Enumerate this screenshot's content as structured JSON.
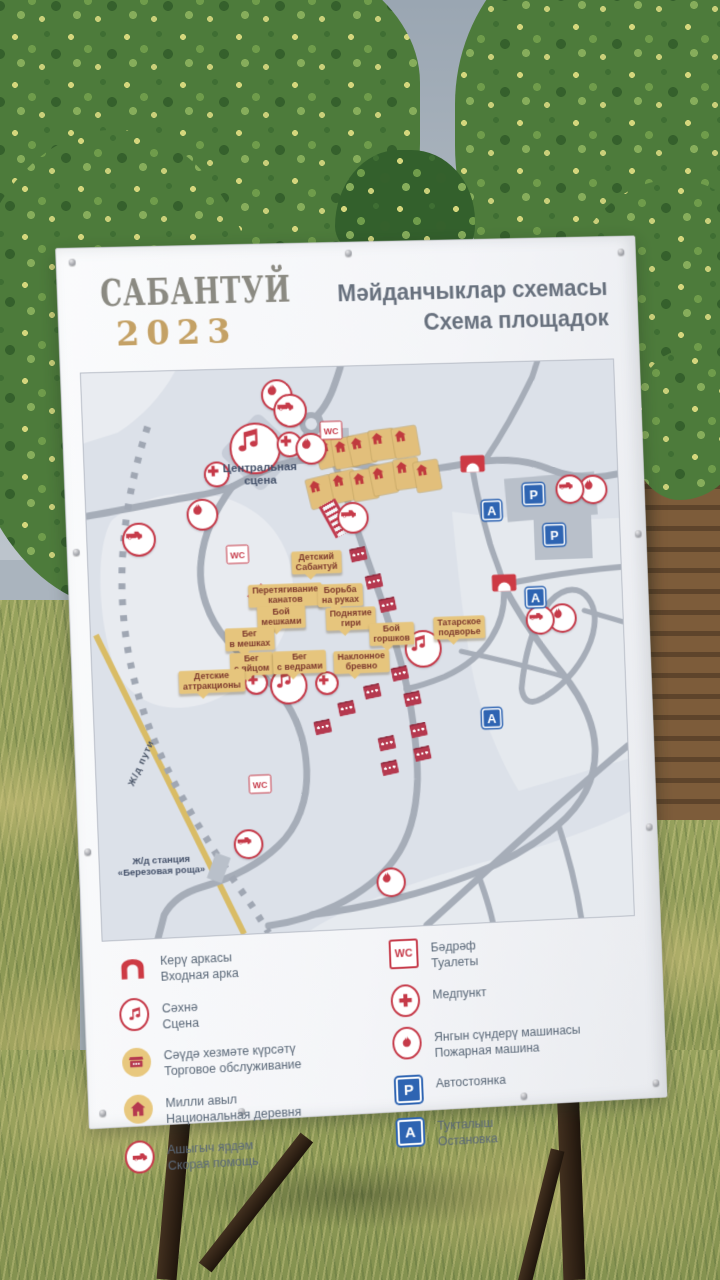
{
  "colors": {
    "accent_red": "#c63a49",
    "accent_blue": "#2e64b2",
    "tan": "#e6c57d",
    "board_white": "#f6f7f9",
    "road_gray": "#a6adb8",
    "railway_yellow": "#d9bc66"
  },
  "sign": {
    "logo": {
      "title": "САБАНТУЙ",
      "year": "2023"
    },
    "heading": {
      "line1": "Мәйданчыклар схемасы",
      "line2": "Схема площадок"
    }
  },
  "map": {
    "stage_label": {
      "line1": "Центральная",
      "line2": "сцена"
    },
    "railway": {
      "track_label": "Ж/д пути",
      "station_line1": "Ж/д станция",
      "station_line2": "«Березовая роща»"
    },
    "letters": {
      "wc": "WC",
      "parking": "P",
      "bus": "А"
    },
    "area_labels": [
      {
        "x": 231,
        "y": 197,
        "lines": [
          "Детский",
          "Сабантуй"
        ]
      },
      {
        "x": 198,
        "y": 229,
        "lines": [
          "Перетягивание",
          "канатов"
        ]
      },
      {
        "x": 254,
        "y": 231,
        "lines": [
          "Борьба",
          "на руках"
        ]
      },
      {
        "x": 193,
        "y": 251,
        "lines": [
          "Бой",
          "мешками"
        ]
      },
      {
        "x": 264,
        "y": 255,
        "lines": [
          "Поднятие",
          "гири"
        ]
      },
      {
        "x": 160,
        "y": 272,
        "lines": [
          "Бег",
          "в мешках"
        ]
      },
      {
        "x": 305,
        "y": 272,
        "lines": [
          "Бой",
          "горшков"
        ]
      },
      {
        "x": 375,
        "y": 268,
        "lines": [
          "Татарское",
          "подворье"
        ]
      },
      {
        "x": 161,
        "y": 297,
        "lines": [
          "Бег",
          "с яйцом"
        ]
      },
      {
        "x": 210,
        "y": 297,
        "lines": [
          "Бег",
          "с ведрами"
        ]
      },
      {
        "x": 273,
        "y": 299,
        "lines": [
          "Наклонное",
          "бревно"
        ]
      },
      {
        "x": 120,
        "y": 313,
        "lines": [
          "Детские",
          "аттракционы"
        ]
      }
    ],
    "markers": [
      {
        "type": "music",
        "x": 173,
        "y": 80,
        "s": 48
      },
      {
        "type": "music",
        "x": 198,
        "y": 320,
        "s": 34
      },
      {
        "type": "music",
        "x": 337,
        "y": 288,
        "s": 34
      },
      {
        "type": "cross",
        "x": 208,
        "y": 77,
        "s": 22
      },
      {
        "type": "cross",
        "x": 133,
        "y": 105,
        "s": 22
      },
      {
        "type": "cross",
        "x": 165,
        "y": 316,
        "s": 20
      },
      {
        "type": "cross",
        "x": 237,
        "y": 319,
        "s": 20
      },
      {
        "type": "fire",
        "x": 197,
        "y": 27,
        "s": 28
      },
      {
        "type": "fire",
        "x": 230,
        "y": 82,
        "s": 28
      },
      {
        "type": "fire",
        "x": 117,
        "y": 145,
        "s": 28
      },
      {
        "type": "fire",
        "x": 519,
        "y": 132,
        "s": 26
      },
      {
        "type": "fire",
        "x": 482,
        "y": 262,
        "s": 26
      },
      {
        "type": "fire",
        "x": 295,
        "y": 523,
        "s": 26
      },
      {
        "type": "ambulance",
        "x": 210,
        "y": 43,
        "s": 30
      },
      {
        "type": "ambulance",
        "x": 52,
        "y": 168,
        "s": 30
      },
      {
        "type": "ambulance",
        "x": 270,
        "y": 153,
        "s": 28
      },
      {
        "type": "ambulance",
        "x": 495,
        "y": 131,
        "s": 26
      },
      {
        "type": "ambulance",
        "x": 459,
        "y": 263,
        "s": 26
      },
      {
        "type": "ambulance",
        "x": 151,
        "y": 478,
        "s": 26
      },
      {
        "type": "wc",
        "x": 251,
        "y": 64
      },
      {
        "type": "wc",
        "x": 151,
        "y": 186
      },
      {
        "type": "wc",
        "x": 165,
        "y": 418
      },
      {
        "type": "arch",
        "x": 395,
        "y": 102
      },
      {
        "type": "arch",
        "x": 423,
        "y": 224
      },
      {
        "type": "parking",
        "x": 457,
        "y": 135,
        "s": 22
      },
      {
        "type": "parking",
        "x": 477,
        "y": 177,
        "s": 22
      },
      {
        "type": "bus",
        "x": 413,
        "y": 150,
        "s": 20
      },
      {
        "type": "bus",
        "x": 455,
        "y": 240,
        "s": 20
      },
      {
        "type": "bus",
        "x": 405,
        "y": 361,
        "s": 20
      }
    ],
    "houses": [
      {
        "x": 248,
        "y": 86,
        "r": -12
      },
      {
        "x": 265,
        "y": 87,
        "r": -8
      },
      {
        "x": 282,
        "y": 84,
        "r": -10
      },
      {
        "x": 303,
        "y": 80,
        "r": -6
      },
      {
        "x": 327,
        "y": 78,
        "r": -8
      },
      {
        "x": 238,
        "y": 126,
        "r": -12
      },
      {
        "x": 262,
        "y": 121,
        "r": -10
      },
      {
        "x": 283,
        "y": 120,
        "r": -8
      },
      {
        "x": 303,
        "y": 115,
        "r": -10
      },
      {
        "x": 327,
        "y": 110,
        "r": -6
      },
      {
        "x": 348,
        "y": 113,
        "r": -8
      }
    ],
    "kiosks": [
      {
        "x": 274,
        "y": 190
      },
      {
        "x": 289,
        "y": 218
      },
      {
        "x": 302,
        "y": 242
      },
      {
        "x": 312,
        "y": 312
      },
      {
        "x": 283,
        "y": 329
      },
      {
        "x": 256,
        "y": 345
      },
      {
        "x": 231,
        "y": 363
      },
      {
        "x": 324,
        "y": 338
      },
      {
        "x": 329,
        "y": 370
      },
      {
        "x": 332,
        "y": 394
      },
      {
        "x": 296,
        "y": 382
      },
      {
        "x": 298,
        "y": 407
      }
    ],
    "ropes": [
      {
        "x": 252,
        "y": 153,
        "r": -27
      },
      {
        "x": 178,
        "y": 236,
        "r": -40
      }
    ]
  },
  "legend": {
    "left": [
      {
        "icon": "entrance-arch",
        "tatar": "Керү аркасы",
        "russian": "Входная арка"
      },
      {
        "icon": "stage",
        "tatar": "Сәхнә",
        "russian": "Сцена"
      },
      {
        "icon": "trade",
        "tatar": "Сәүдә хезмәте күрсәтү",
        "russian": "Торговое обслуживание"
      },
      {
        "icon": "village",
        "tatar": "Милли авыл",
        "russian": "Национальная деревня"
      },
      {
        "icon": "ambulance",
        "tatar": "Ашыгыч ярдәм",
        "russian": "Скорая помощь"
      }
    ],
    "right": [
      {
        "icon": "wc",
        "tatar": "Бәдрәф",
        "russian": "Туалеты"
      },
      {
        "icon": "medpoint",
        "tatar": "Медпункт",
        "russian": ""
      },
      {
        "icon": "fire-truck",
        "tatar": "Янгын сүндерү машинасы",
        "russian": "Пожарная машина"
      },
      {
        "icon": "parking",
        "tatar": "Автостоянка",
        "russian": ""
      },
      {
        "icon": "bus-stop",
        "tatar": "Тукталыш",
        "russian": "Остановка"
      }
    ]
  }
}
